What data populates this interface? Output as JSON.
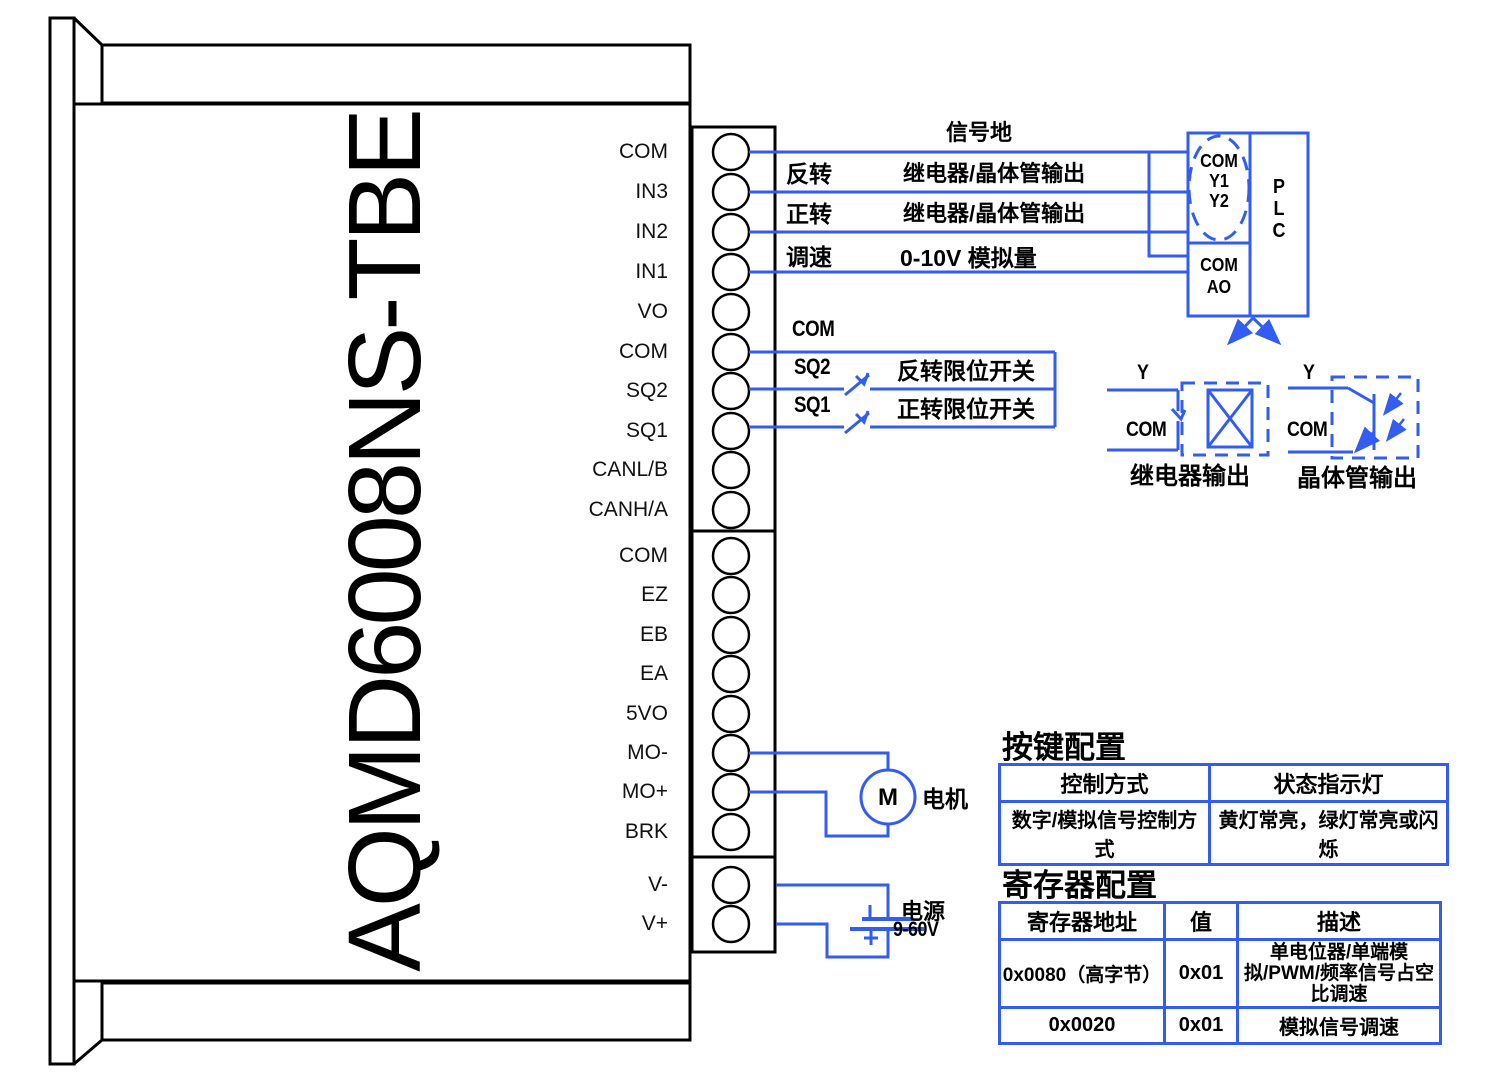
{
  "device": {
    "model": "AQMD6008NS-TBE"
  },
  "terminals": {
    "group1": [
      "COM",
      "IN3",
      "IN2",
      "IN1",
      "VO",
      "COM",
      "SQ2",
      "SQ1",
      "CANL/B",
      "CANH/A"
    ],
    "group2": [
      "COM",
      "EZ",
      "EB",
      "EA",
      "5VO",
      "MO-",
      "MO+",
      "BRK"
    ],
    "group3": [
      "V-",
      "V+"
    ]
  },
  "wiring": {
    "signal_ground": "信号地",
    "reverse": {
      "name": "反转",
      "target": "继电器/晶体管输出"
    },
    "forward": {
      "name": "正转",
      "target": "继电器/晶体管输出"
    },
    "speed": {
      "name": "调速",
      "target": "0-10V  模拟量"
    },
    "com": "COM",
    "sq2": {
      "name": "SQ2",
      "desc": "反转限位开关"
    },
    "sq1": {
      "name": "SQ1",
      "desc": "正转限位开关"
    }
  },
  "plc": {
    "io_top": [
      "COM",
      "Y1",
      "Y2"
    ],
    "io_bottom": [
      "COM",
      "AO"
    ],
    "name": [
      "P",
      "L",
      "C"
    ]
  },
  "outputs": {
    "relay": {
      "pin": "Y",
      "com": "COM",
      "caption": "继电器输出"
    },
    "transistor": {
      "pin": "Y",
      "com": "COM",
      "caption": "晶体管输出"
    }
  },
  "motor": {
    "symbol": "M",
    "label": "电机"
  },
  "power": {
    "label": "电源",
    "voltage": "9-60V",
    "plus": "+"
  },
  "tables": {
    "key_config": {
      "title": "按键配置",
      "headers": [
        "控制方式",
        "状态指示灯"
      ],
      "rows": [
        [
          "数字/模拟信号控制方式",
          "黄灯常亮，绿灯常亮或闪烁"
        ]
      ]
    },
    "register_config": {
      "title": "寄存器配置",
      "headers": [
        "寄存器地址",
        "值",
        "描述"
      ],
      "rows": [
        [
          "0x0080（高字节）",
          "0x01",
          "单电位器/单端模拟/PWM/频率信号占空比调速"
        ],
        [
          "0x0020",
          "0x01",
          "模拟信号调速"
        ]
      ]
    }
  },
  "colors": {
    "wire_blue": "#335cf3",
    "line_black": "#000000"
  }
}
